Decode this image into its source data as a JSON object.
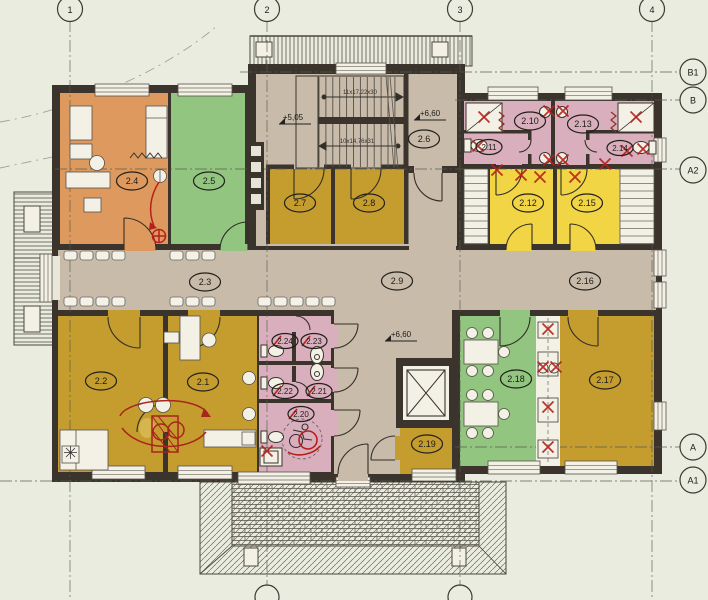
{
  "plan": {
    "grid_top": [
      "1",
      "2",
      "3",
      "4"
    ],
    "grid_right": [
      "B1",
      "B",
      "A2",
      "A",
      "A1"
    ],
    "levels": {
      "stair": "+5,05",
      "landing": "+6,60",
      "corridor": "+6,60"
    },
    "stairs": {
      "upper": "11x17,22x30",
      "lower": "10x14,76x31"
    }
  },
  "rooms": {
    "r2_1": "2.1",
    "r2_2": "2.2",
    "r2_3": "2.3",
    "r2_4": "2.4",
    "r2_5": "2.5",
    "r2_6": "2.6",
    "r2_7": "2.7",
    "r2_8": "2.8",
    "r2_9": "2.9",
    "r2_10": "2.10",
    "r2_11": "2.11",
    "r2_12": "2.12",
    "r2_13": "2.13",
    "r2_14": "2.14",
    "r2_15": "2.15",
    "r2_16": "2.16",
    "r2_17": "2.17",
    "r2_18": "2.18",
    "r2_19": "2.19",
    "r2_20": "2.20",
    "r2_21": "2.21",
    "r2_22": "2.22",
    "r2_23": "2.23",
    "r2_24": "2.24"
  },
  "colors": {
    "paper": "#e9ecdf",
    "wall": "#3a342c",
    "hall": "#c8bbaa",
    "orange": "#de9a5e",
    "green": "#92c57f",
    "mustard": "#c49d2e",
    "yellow": "#f2d544",
    "pink": "#d9afbd",
    "fixture": "#f3f1e6",
    "red": "#b5201c"
  }
}
